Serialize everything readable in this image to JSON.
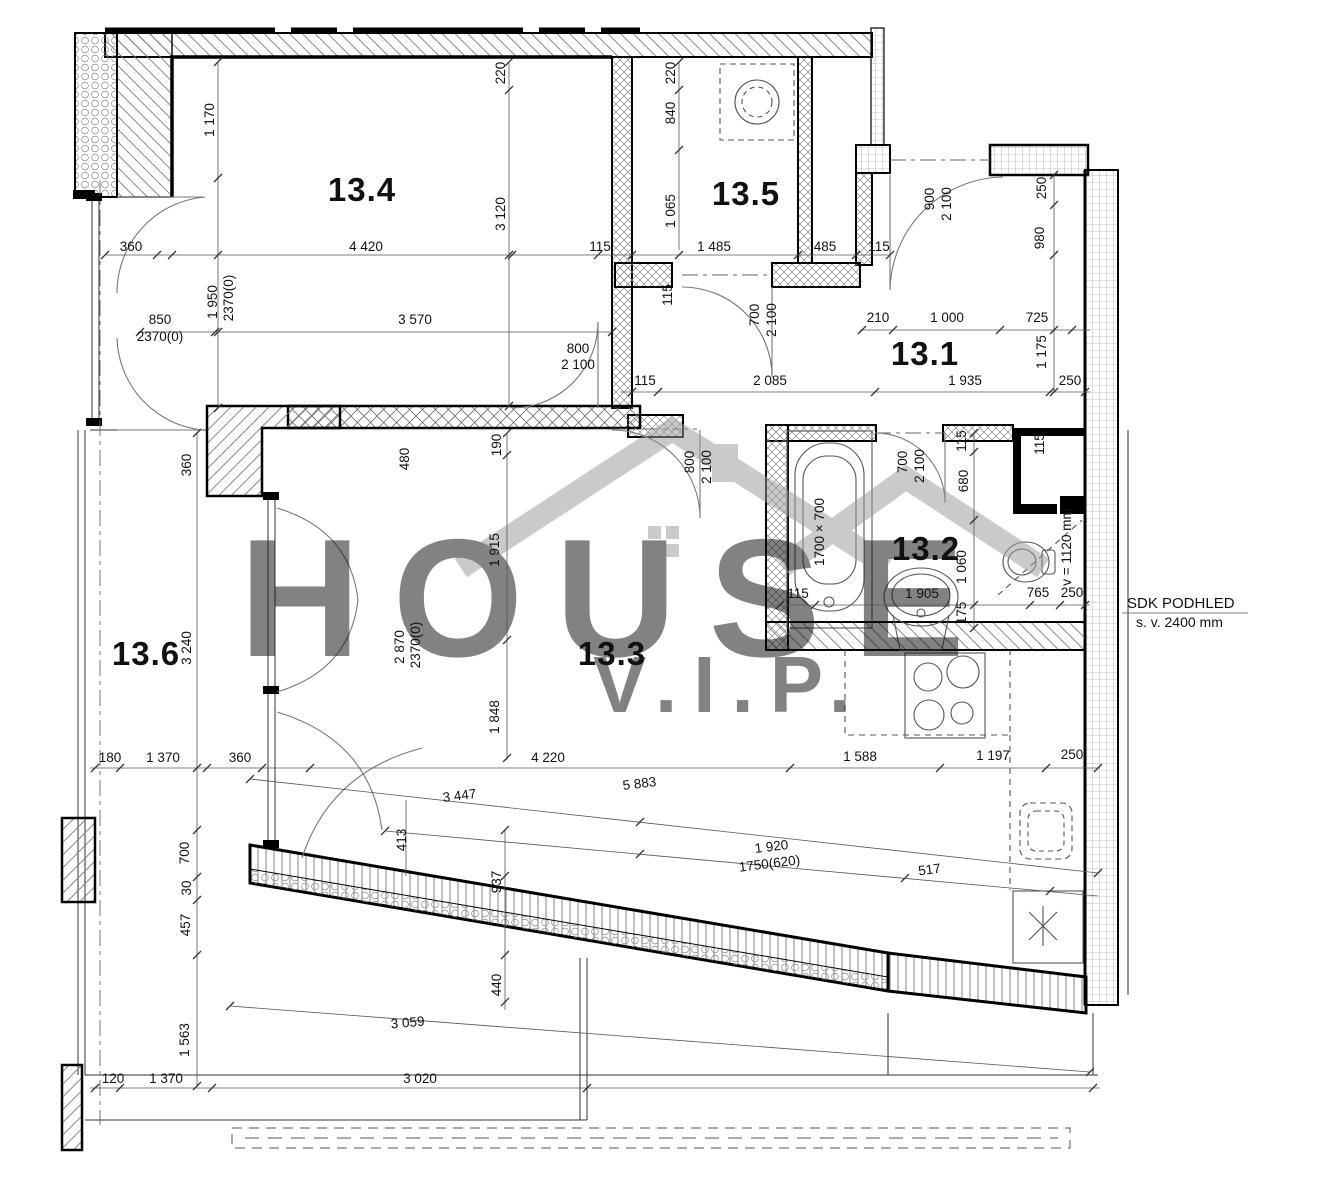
{
  "watermark": {
    "word": "HOUSE",
    "sub": "V.I.P."
  },
  "annotation": {
    "title": "SDK PODHLED",
    "subtitle": "s. v. 2400 mm"
  },
  "rooms": [
    "13.4",
    "13.5",
    "13.1",
    "13.2",
    "13.3",
    "13.6"
  ],
  "dims": {
    "horizontal": [
      "360",
      "4 420",
      "115",
      "1 485",
      "485",
      "115",
      "850",
      "2370(0)",
      "3 570",
      "800",
      "2 100",
      "210",
      "1 000",
      "725",
      "115",
      "2 085",
      "1 935",
      "250",
      "115",
      "1 905",
      "765",
      "250",
      "180",
      "1 370",
      "360",
      "4 220",
      "1 588",
      "1 197",
      "250",
      "120",
      "1 370",
      "3 020"
    ],
    "vertical": [
      "1 170",
      "220",
      "3 120",
      "220",
      "840",
      "1 065",
      "1 950",
      "2370(0)",
      "900",
      "2 100",
      "250",
      "980",
      "1 175",
      "700",
      "2 100",
      "115",
      "360",
      "480",
      "190",
      "800",
      "2 100",
      "700",
      "2 100",
      "115",
      "680",
      "115",
      "1700 × 700",
      "1 915",
      "1 060",
      "175",
      "v = 1120 mm",
      "2 870",
      "2370(0)",
      "3 240",
      "1 848",
      "413",
      "937",
      "700",
      "30",
      "457",
      "1 563",
      "440"
    ],
    "slanted": [
      "3 447",
      "5 883",
      "1 920",
      "1750(620)",
      "517",
      "3 059"
    ]
  },
  "fixtures": [
    "washing-machine",
    "bathtub",
    "washbasin",
    "toilet",
    "stove",
    "kitchen-sink",
    "dishwasher"
  ],
  "colors": {
    "wall": "#000000",
    "thin_line": "#444444",
    "dim_text": "#111111",
    "watermark": "#c6c6c6"
  }
}
